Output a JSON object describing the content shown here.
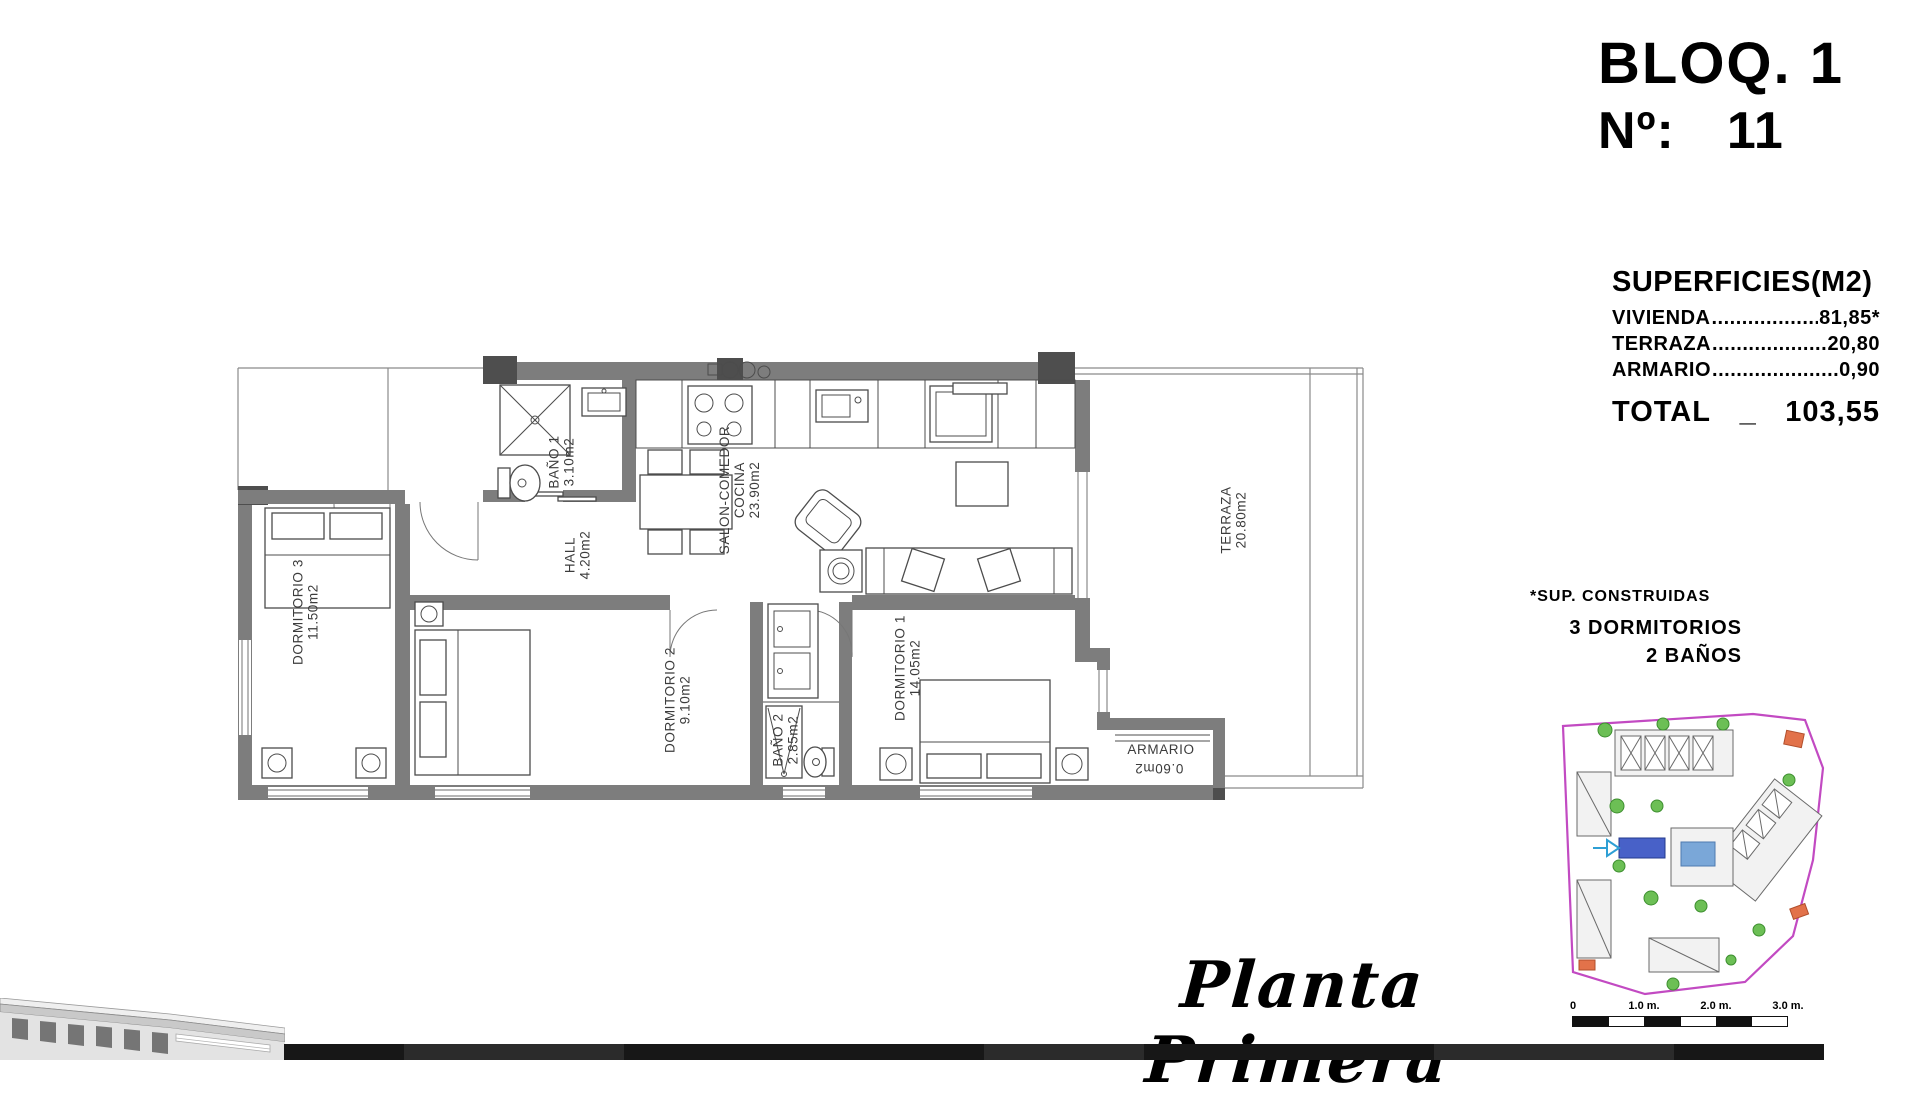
{
  "header": {
    "block": "BLOQ. 1",
    "number_label": "Nº:",
    "number": "11"
  },
  "surfaces": {
    "title": "SUPERFICIES(M2)",
    "rows": [
      {
        "label": "VIVIENDA",
        "dots": "....................................",
        "value": "81,85*"
      },
      {
        "label": "TERRAZA",
        "dots": "....................................",
        "value": "20,80"
      },
      {
        "label": "ARMARIO",
        "dots": "....................................",
        "value": "0,90"
      }
    ],
    "total_label": "TOTAL",
    "total_sep": "_",
    "total_value": "103,55"
  },
  "notes": {
    "constructed": "*SUP. CONSTRUIDAS",
    "bedrooms": "3 DORMITORIOS",
    "bathrooms": "2 BAÑOS"
  },
  "plan_title": "Planta Primera",
  "floor_plan": {
    "labels": [
      {
        "x": 336,
        "y": 112,
        "rot": -90,
        "lines": [
          "BAÑO 1",
          "3.10m2"
        ]
      },
      {
        "x": 352,
        "y": 205,
        "rot": -90,
        "lines": [
          "HALL",
          "4.20m2"
        ]
      },
      {
        "x": 514,
        "y": 140,
        "rot": -90,
        "lines": [
          "SALON-COMEDOR",
          "COCINA",
          "23.90m2"
        ]
      },
      {
        "x": 1008,
        "y": 170,
        "rot": -90,
        "lines": [
          "TERRAZA",
          "20.80m2"
        ]
      },
      {
        "x": 80,
        "y": 262,
        "rot": -90,
        "lines": [
          "DORMITORIO 3",
          "11.50m2"
        ]
      },
      {
        "x": 452,
        "y": 350,
        "rot": -90,
        "lines": [
          "DORMITORIO 2",
          "9.10m2"
        ]
      },
      {
        "x": 560,
        "y": 390,
        "rot": -90,
        "lines": [
          "BAÑO 2",
          "2.85m2"
        ]
      },
      {
        "x": 682,
        "y": 318,
        "rot": -90,
        "lines": [
          "DORMITORIO 1",
          "14.05m2"
        ]
      },
      {
        "x": 931,
        "y": 404,
        "rot": 0,
        "lines": [
          "ARMARIO"
        ]
      },
      {
        "x": 929,
        "y": 414,
        "rot": 180,
        "lines": [
          "0.60m2"
        ]
      }
    ]
  },
  "site_plan": {
    "scale_labels": [
      "0",
      "1.0 m.",
      "2.0 m.",
      "3.0 m."
    ]
  }
}
